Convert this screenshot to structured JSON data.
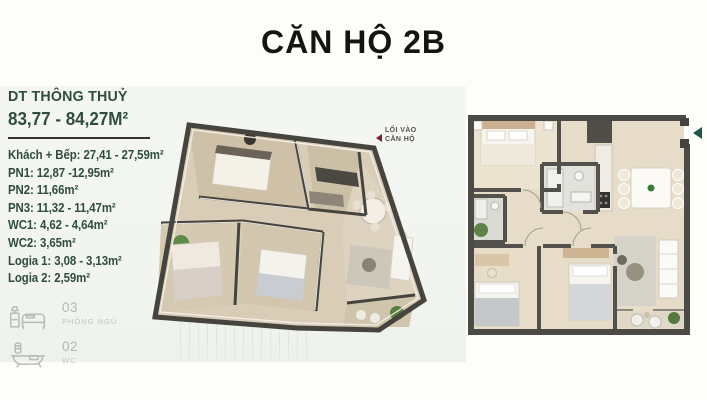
{
  "page_title": "CĂN HỘ 2B",
  "sidebar": {
    "heading": "DT THÔNG THUỶ",
    "area_range": "83,77 - 84,27M²",
    "rooms": [
      "Khách + Bếp: 27,41 - 27,59m²",
      "PN1: 12,87 -12,95m²",
      "PN2: 11,66m²",
      "PN3: 11,32 - 11,47m²",
      "WC1: 4,62 - 4,64m²",
      "WC2: 3,65m²",
      "Logia 1: 3,08 - 3,13m²",
      "Logia 2: 2,59m²"
    ],
    "stats": [
      {
        "icon": "bed-icon",
        "count": "03",
        "label": "PHÒNG NGỦ"
      },
      {
        "icon": "bathtub-icon",
        "count": "02",
        "label": "WC"
      }
    ]
  },
  "plan_3d": {
    "kind": "isometric-floorplan-render",
    "entrance": {
      "line1": "LỐI VÀO",
      "line2": "CĂN HỘ",
      "arrow_icon": "arrow-left-icon",
      "arrow_color": "#7d2230"
    }
  },
  "plan_2d": {
    "kind": "top-view-floorplan",
    "entrance_arrow_icon": "arrow-left-icon",
    "entrance_arrow_color": "#1c5741"
  },
  "colors": {
    "accent_green": "#2f4d3b",
    "title_black": "#12160f",
    "muted_icon_gray": "#b7bbb2",
    "wall_dark": "#4b4a44",
    "floor_beige": "#e6dcc8",
    "panel_gray": "#f3f5f1"
  }
}
